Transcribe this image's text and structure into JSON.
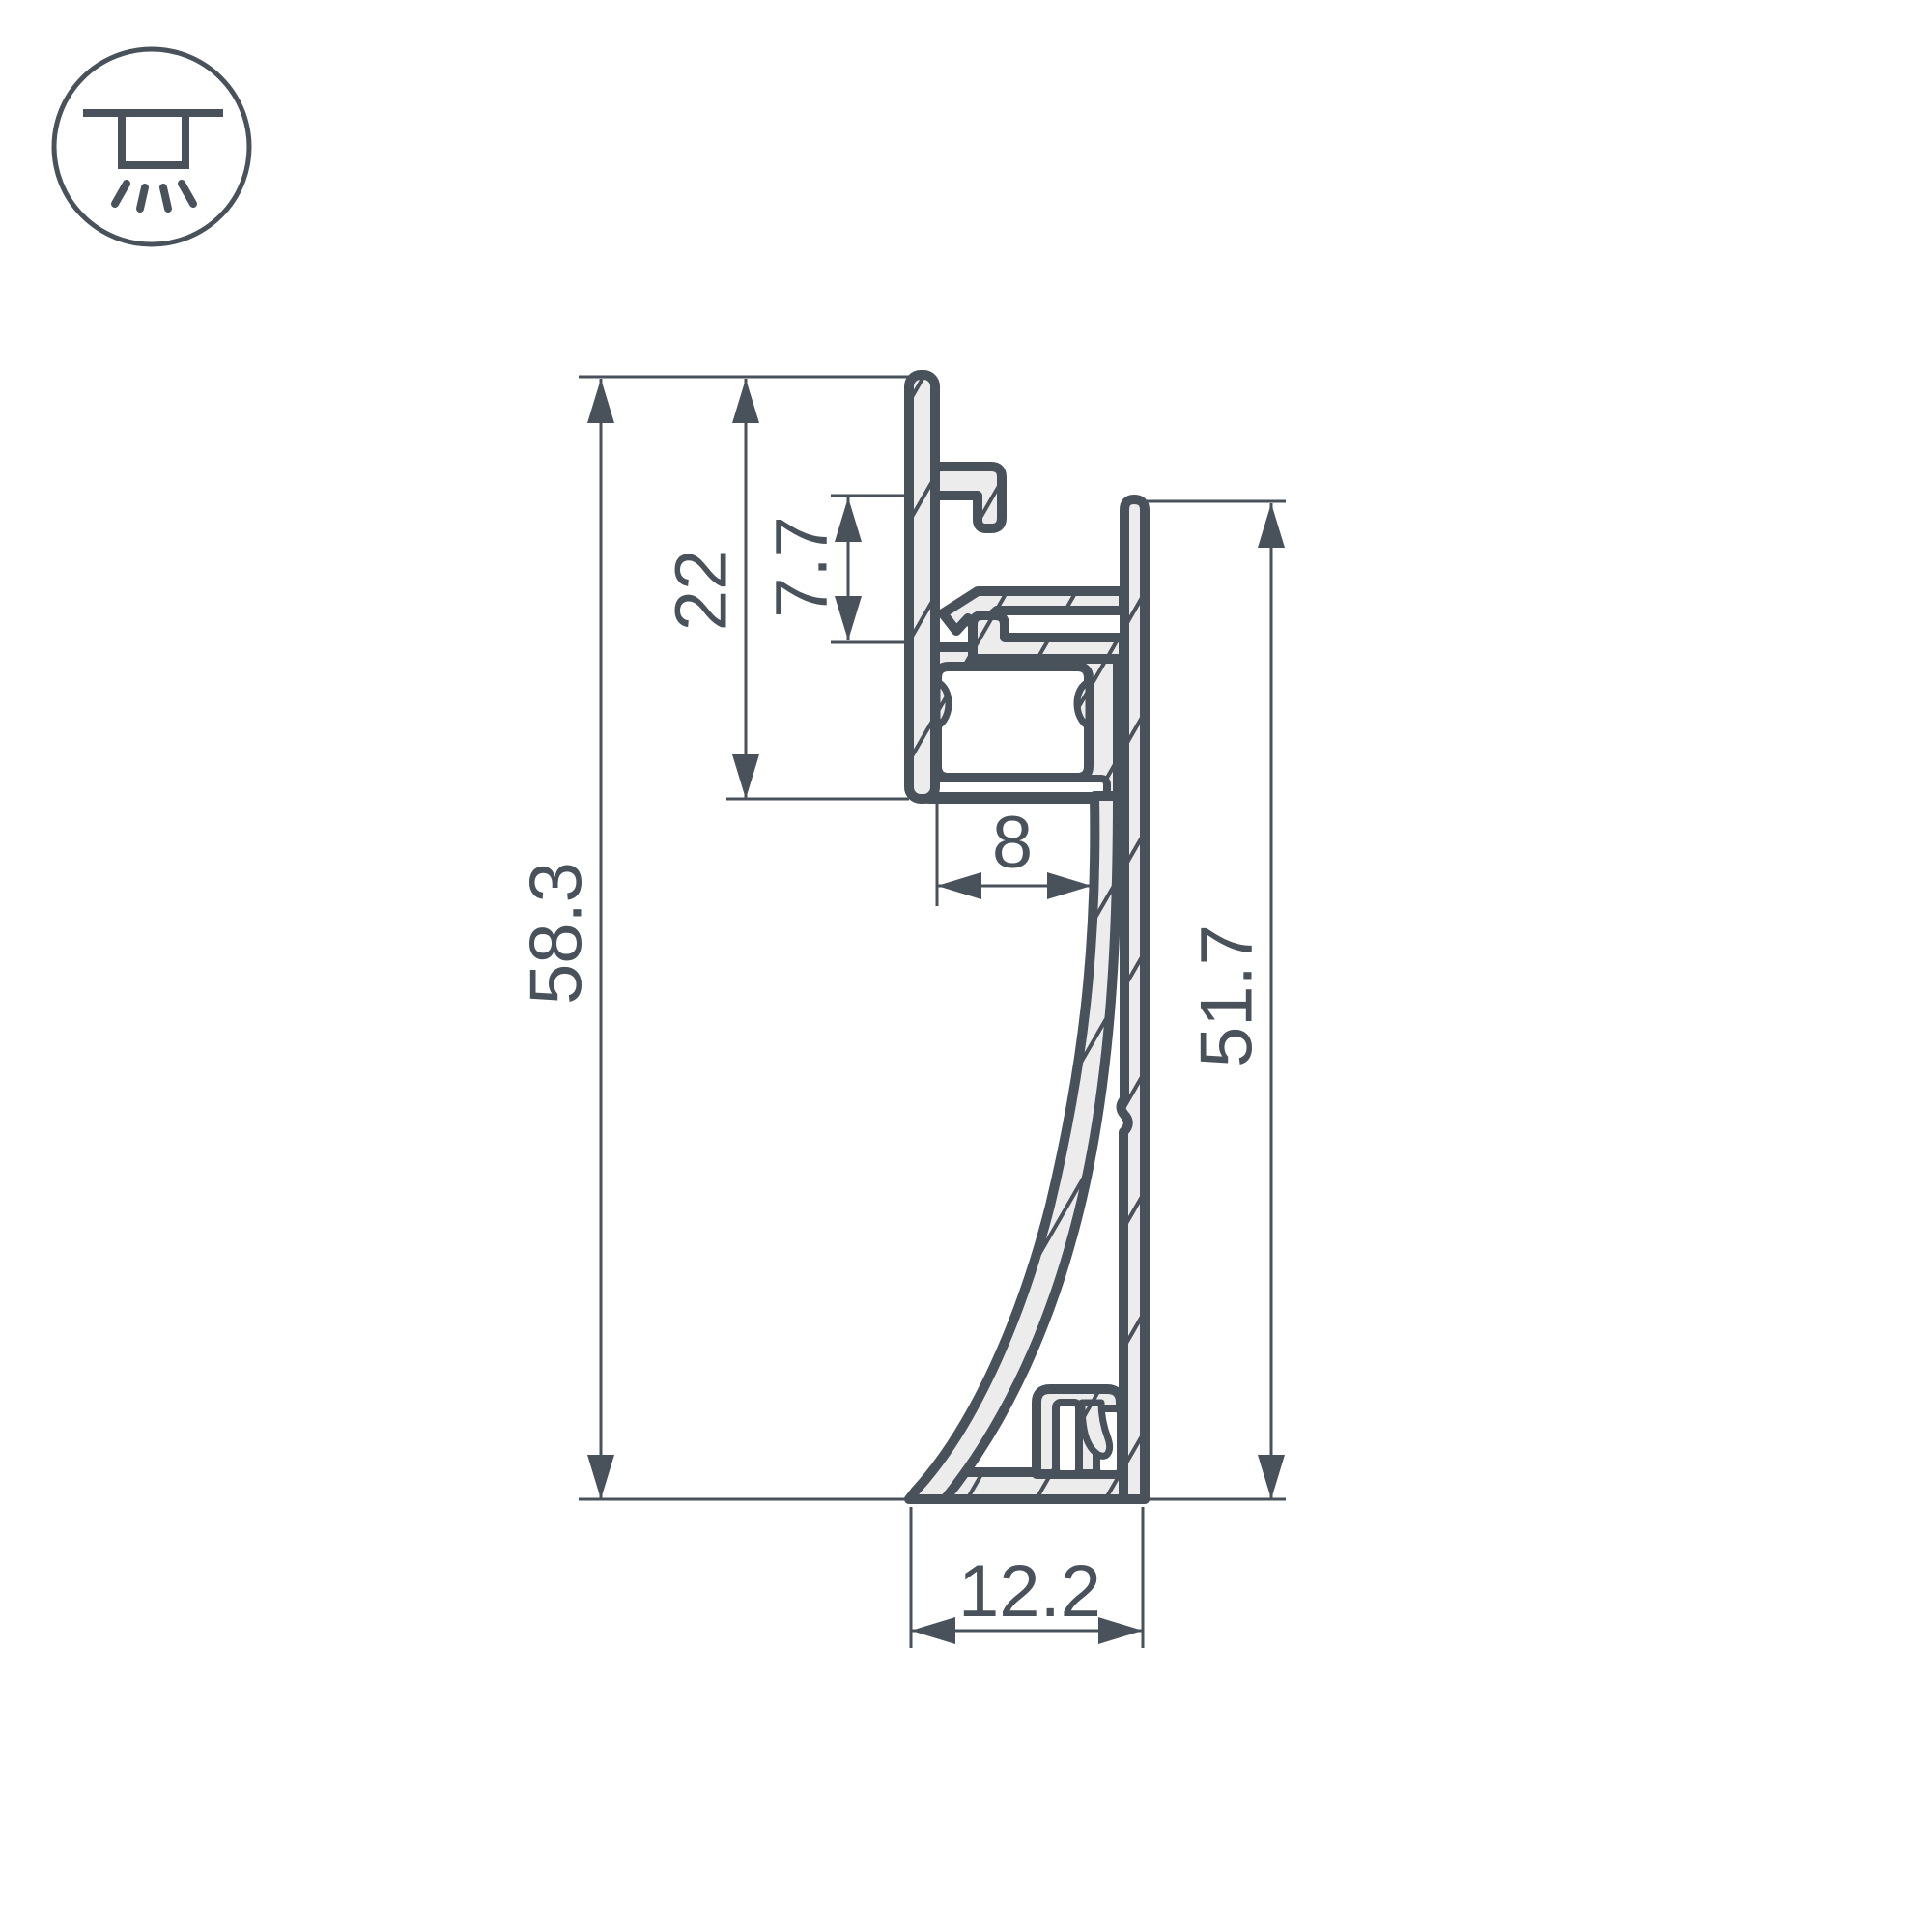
{
  "colors": {
    "line": "#49525b",
    "fill": "#ececec",
    "background": "#ffffff"
  },
  "icon": {
    "name": "recessed-ceiling-light"
  },
  "dimensions": {
    "overall_height": "58.3",
    "wall_height": "22",
    "slot_depth": "7.7",
    "channel_width": "8",
    "front_height": "51.7",
    "base_width": "12.2"
  }
}
